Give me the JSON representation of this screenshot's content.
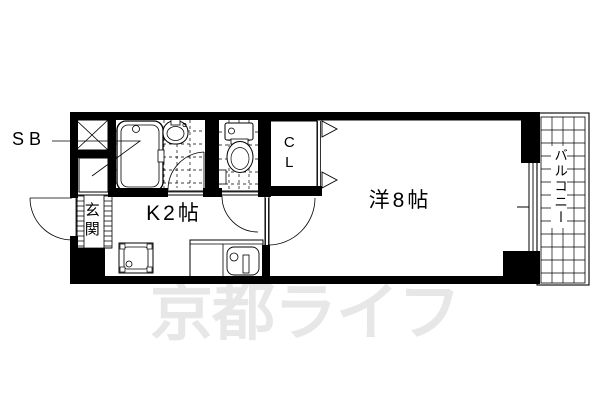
{
  "canvas": {
    "background": "#ffffff",
    "line_color": "#000000"
  },
  "watermark": {
    "text": "京都ライフ",
    "color": "#e7e7e7"
  },
  "labels": {
    "shoe_box": "SB",
    "entrance": "玄関",
    "kitchen": "K2帖",
    "western_room": "洋8帖",
    "closet": "CL",
    "balcony": "バルコニー"
  }
}
